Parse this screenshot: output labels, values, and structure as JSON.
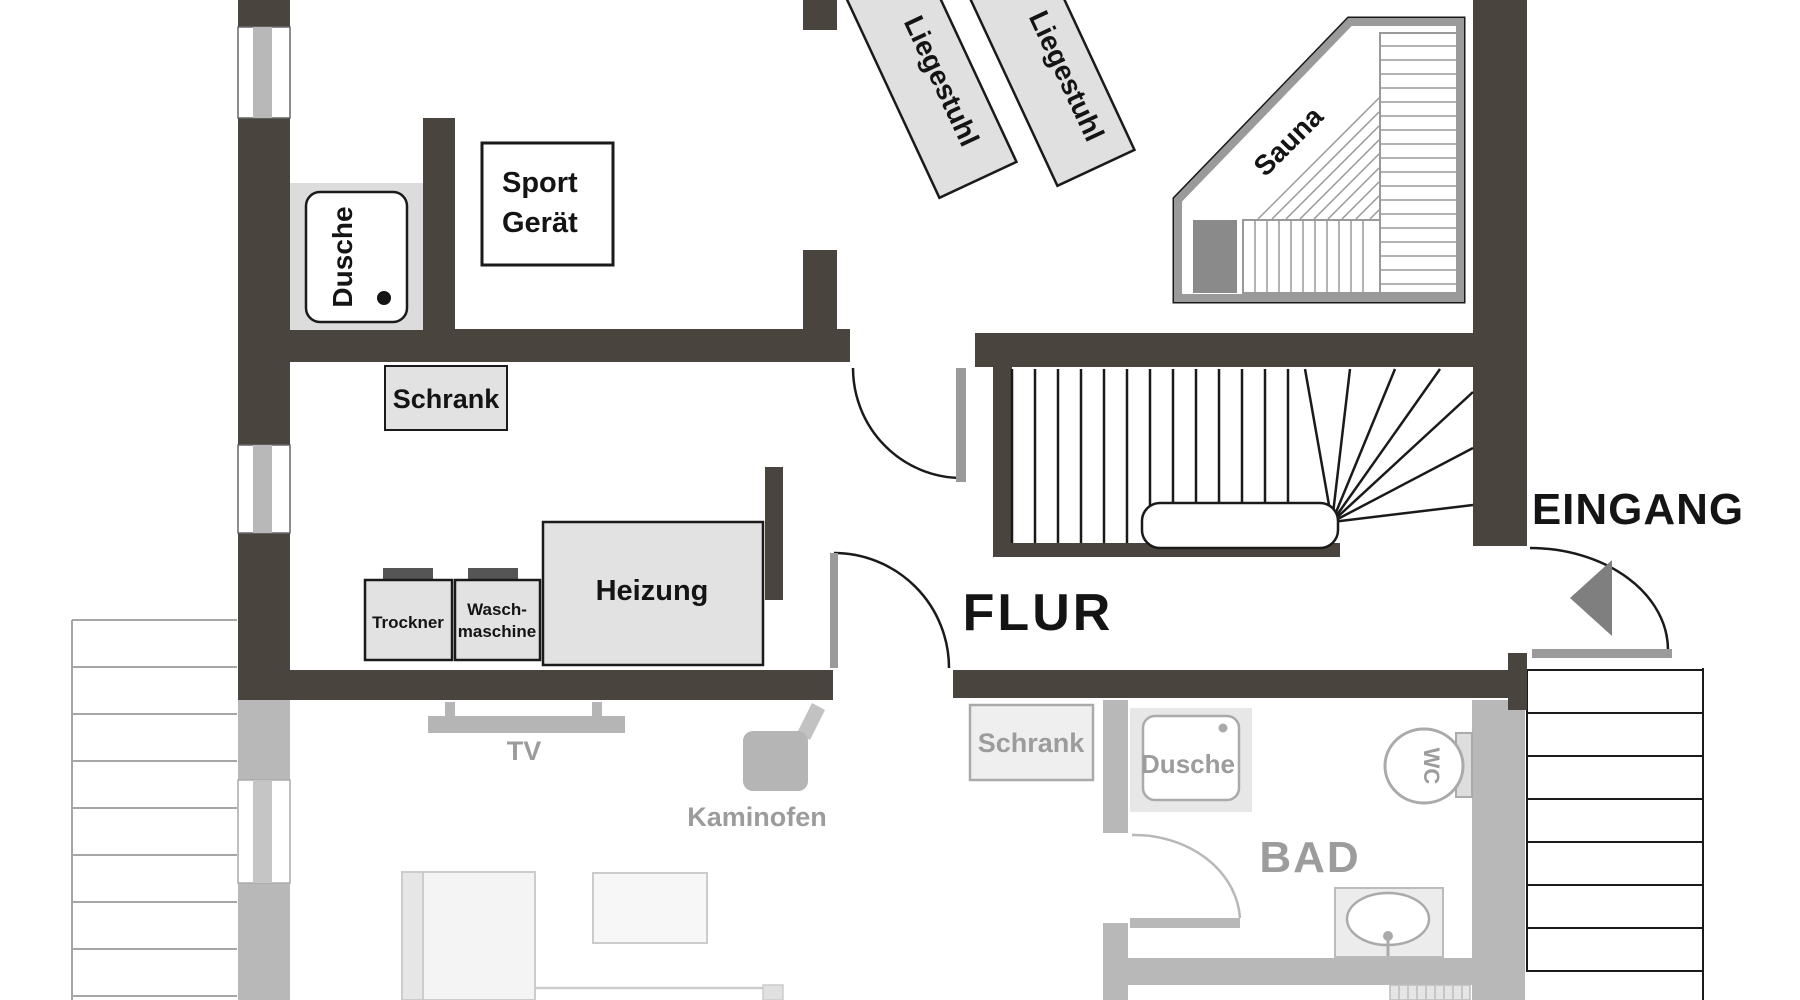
{
  "plan": {
    "type": "floor-plan",
    "language": "de",
    "rooms": {
      "flur": "FLUR",
      "eingang": "EINGANG",
      "bad": "BAD"
    },
    "upper_floor_labels": {
      "dusche": "Dusche",
      "sport_geraet_line1": "Sport",
      "sport_geraet_line2": "Gerät",
      "liegestuhl": "Liegestuhl",
      "sauna": "Sauna",
      "schrank": "Schrank",
      "trockner": "Trockner",
      "waschmaschine_line1": "Wasch-",
      "waschmaschine_line2": "maschine",
      "heizung": "Heizung"
    },
    "lower_floor_labels": {
      "tv": "TV",
      "kaminofen": "Kaminofen",
      "schrank": "Schrank",
      "dusche": "Dusche",
      "wc": "WC",
      "bad": "BAD"
    },
    "colors": {
      "wall_dark": "#49443d",
      "wall_lower_gray": "#b8b8b8",
      "fixture_fill": "#e2e2e2",
      "appliance_top": "#555555",
      "sauna_border_gray": "#9a9a9a",
      "sauna_heater": "#8a8a8a",
      "door_leaf": "#9a9a9a",
      "label_black": "#141414",
      "label_gray": "#9c9c9c",
      "lower_fixture_stroke": "#aaaaaa",
      "background": "#ffffff"
    }
  }
}
